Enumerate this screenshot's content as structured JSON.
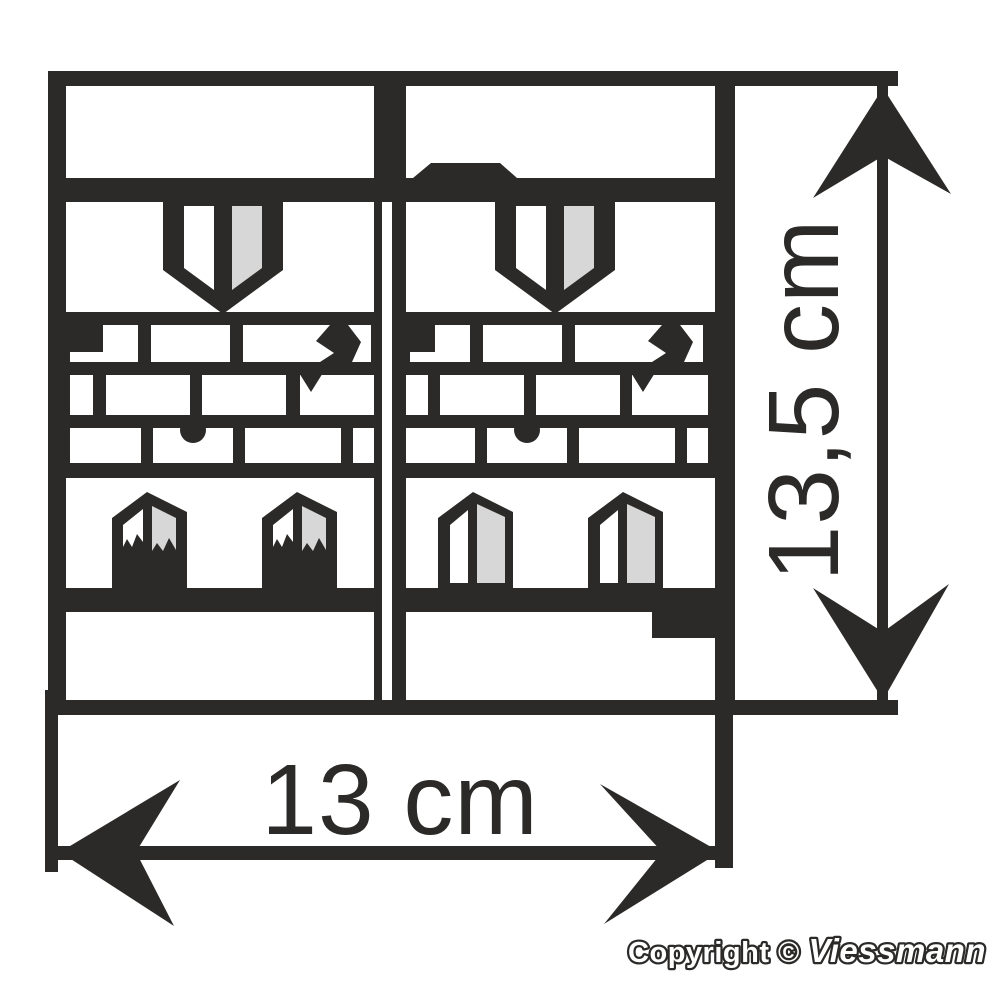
{
  "drawing": {
    "title": "wall-kit-dimension-drawing"
  },
  "dimensions": {
    "width": {
      "label": "13 cm"
    },
    "height": {
      "label": "13,5 cm"
    }
  },
  "copyright": {
    "prefix": "Copyright © ",
    "brand": "Viessmann"
  },
  "colors": {
    "ink": "#2b2a28",
    "pane_gray": "#d7d7d7",
    "background": "#ffffff"
  }
}
